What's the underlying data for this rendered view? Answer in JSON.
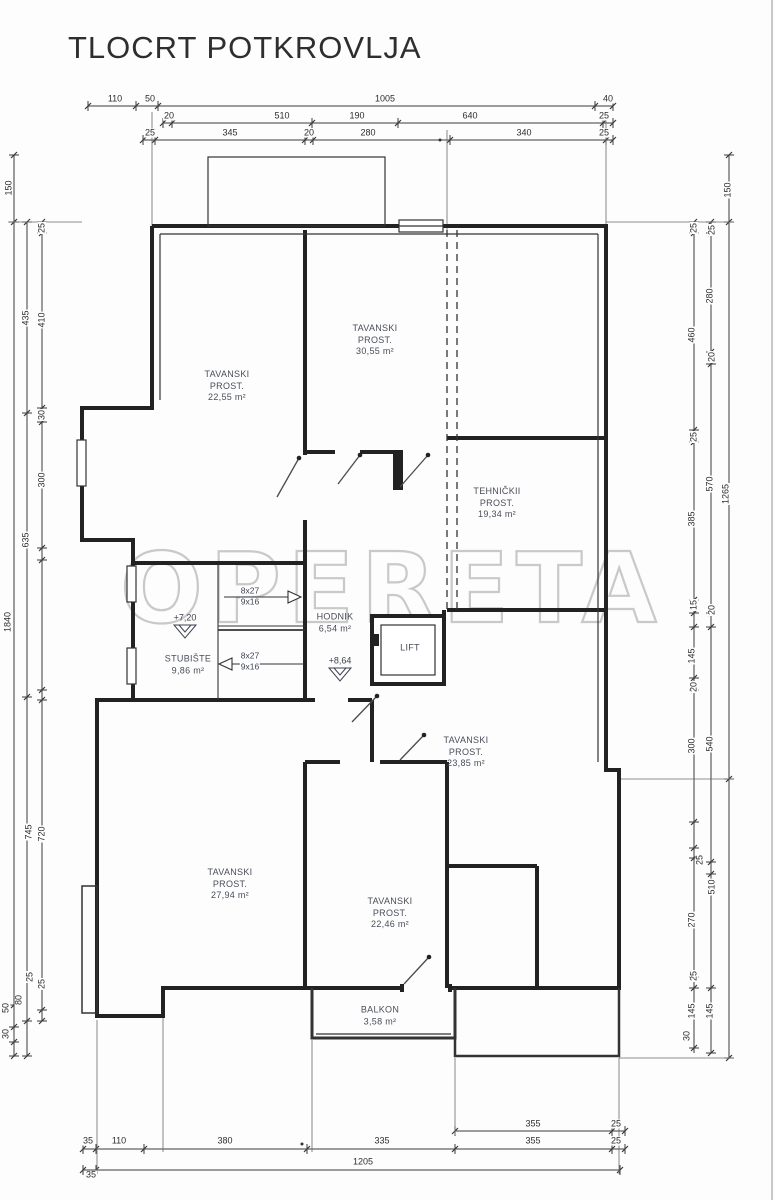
{
  "title": "TLOCRT POTKROVLJA",
  "watermark": "OPERETA",
  "rooms": [
    {
      "lines": [
        "TAVANSKI",
        "PROST.",
        "22,55 m²"
      ],
      "x": 227,
      "y": 386
    },
    {
      "lines": [
        "TAVANSKI",
        "PROST.",
        "30,55 m²"
      ],
      "x": 375,
      "y": 340
    },
    {
      "lines": [
        "TEHNIČKII",
        "PROST.",
        "19,34 m²"
      ],
      "x": 497,
      "y": 503
    },
    {
      "lines": [
        "STUBIŠTE",
        "9,86 m²"
      ],
      "x": 188,
      "y": 665
    },
    {
      "lines": [
        "HODNIK",
        "6,54 m²"
      ],
      "x": 335,
      "y": 623
    },
    {
      "lines": [
        "LIFT"
      ],
      "x": 410,
      "y": 648
    },
    {
      "lines": [
        "TAVANSKI",
        "PROST.",
        "23,85 m²"
      ],
      "x": 466,
      "y": 752
    },
    {
      "lines": [
        "TAVANSKI",
        "PROST.",
        "27,94 m²"
      ],
      "x": 230,
      "y": 884
    },
    {
      "lines": [
        "TAVANSKI",
        "PROST.",
        "22,46 m²"
      ],
      "x": 390,
      "y": 913
    },
    {
      "lines": [
        "BALKON",
        "3,58 m²"
      ],
      "x": 380,
      "y": 1016
    }
  ],
  "stair_labels": [
    {
      "text": "8x27",
      "x": 250,
      "y": 591
    },
    {
      "text": "9x16",
      "x": 250,
      "y": 602
    },
    {
      "text": "8x27",
      "x": 250,
      "y": 656
    },
    {
      "text": "9x16",
      "x": 250,
      "y": 667
    }
  ],
  "elevation_markers": [
    {
      "text": "+7,20",
      "x": 185,
      "y": 618
    },
    {
      "text": "+8,64",
      "x": 340,
      "y": 661
    }
  ],
  "dim_labels": [
    {
      "text": "110",
      "x": 115,
      "y": 99,
      "rot": false
    },
    {
      "text": "50",
      "x": 150,
      "y": 99,
      "rot": false
    },
    {
      "text": "1005",
      "x": 385,
      "y": 99,
      "rot": false
    },
    {
      "text": "40",
      "x": 608,
      "y": 99,
      "rot": false
    },
    {
      "text": "20",
      "x": 169,
      "y": 116,
      "rot": false
    },
    {
      "text": "510",
      "x": 282,
      "y": 116,
      "rot": false
    },
    {
      "text": "190",
      "x": 357,
      "y": 116,
      "rot": false
    },
    {
      "text": "640",
      "x": 470,
      "y": 116,
      "rot": false
    },
    {
      "text": "25",
      "x": 604,
      "y": 116,
      "rot": false
    },
    {
      "text": "25",
      "x": 150,
      "y": 133,
      "rot": false
    },
    {
      "text": "345",
      "x": 230,
      "y": 133,
      "rot": false
    },
    {
      "text": "20",
      "x": 309,
      "y": 133,
      "rot": false
    },
    {
      "text": "280",
      "x": 368,
      "y": 133,
      "rot": false
    },
    {
      "text": "340",
      "x": 524,
      "y": 133,
      "rot": false
    },
    {
      "text": "25",
      "x": 604,
      "y": 133,
      "rot": false
    },
    {
      "text": "150",
      "x": 9,
      "y": 188,
      "rot": true
    },
    {
      "text": "1840",
      "x": 8,
      "y": 622,
      "rot": true
    },
    {
      "text": "50",
      "x": 6,
      "y": 1008,
      "rot": true
    },
    {
      "text": "30",
      "x": 6,
      "y": 1034,
      "rot": true
    },
    {
      "text": "435",
      "x": 26,
      "y": 318,
      "rot": true
    },
    {
      "text": "635",
      "x": 26,
      "y": 540,
      "rot": true
    },
    {
      "text": "745",
      "x": 29,
      "y": 832,
      "rot": true
    },
    {
      "text": "80",
      "x": 19,
      "y": 1000,
      "rot": true
    },
    {
      "text": "25",
      "x": 42,
      "y": 228,
      "rot": true
    },
    {
      "text": "410",
      "x": 42,
      "y": 320,
      "rot": true
    },
    {
      "text": "30",
      "x": 42,
      "y": 415,
      "rot": true
    },
    {
      "text": "300",
      "x": 42,
      "y": 480,
      "rot": true
    },
    {
      "text": "720",
      "x": 42,
      "y": 834,
      "rot": true
    },
    {
      "text": "25",
      "x": 30,
      "y": 977,
      "rot": true
    },
    {
      "text": "25",
      "x": 42,
      "y": 984,
      "rot": true
    },
    {
      "text": "25",
      "x": 694,
      "y": 228,
      "rot": true
    },
    {
      "text": "460",
      "x": 692,
      "y": 335,
      "rot": true
    },
    {
      "text": "25",
      "x": 694,
      "y": 437,
      "rot": true
    },
    {
      "text": "385",
      "x": 692,
      "y": 519,
      "rot": true
    },
    {
      "text": "15",
      "x": 694,
      "y": 605,
      "rot": true
    },
    {
      "text": "145",
      "x": 692,
      "y": 656,
      "rot": true
    },
    {
      "text": "20",
      "x": 694,
      "y": 687,
      "rot": true
    },
    {
      "text": "300",
      "x": 692,
      "y": 746,
      "rot": true
    },
    {
      "text": "25",
      "x": 700,
      "y": 860,
      "rot": true
    },
    {
      "text": "270",
      "x": 692,
      "y": 920,
      "rot": true
    },
    {
      "text": "25",
      "x": 694,
      "y": 976,
      "rot": true
    },
    {
      "text": "145",
      "x": 692,
      "y": 1011,
      "rot": true
    },
    {
      "text": "30",
      "x": 687,
      "y": 1036,
      "rot": true
    },
    {
      "text": "25",
      "x": 712,
      "y": 230,
      "rot": true
    },
    {
      "text": "280",
      "x": 710,
      "y": 296,
      "rot": true
    },
    {
      "text": "20",
      "x": 712,
      "y": 357,
      "rot": true
    },
    {
      "text": "570",
      "x": 710,
      "y": 484,
      "rot": true
    },
    {
      "text": "20",
      "x": 712,
      "y": 610,
      "rot": true
    },
    {
      "text": "540",
      "x": 710,
      "y": 744,
      "rot": true
    },
    {
      "text": "510",
      "x": 712,
      "y": 887,
      "rot": true
    },
    {
      "text": "145",
      "x": 710,
      "y": 1011,
      "rot": true
    },
    {
      "text": "150",
      "x": 728,
      "y": 190,
      "rot": true
    },
    {
      "text": "1265",
      "x": 726,
      "y": 494,
      "rot": true
    },
    {
      "text": "355",
      "x": 533,
      "y": 1124,
      "rot": false
    },
    {
      "text": "25",
      "x": 616,
      "y": 1124,
      "rot": false
    },
    {
      "text": "35",
      "x": 88,
      "y": 1141,
      "rot": false
    },
    {
      "text": "110",
      "x": 119,
      "y": 1141,
      "rot": false
    },
    {
      "text": "380",
      "x": 225,
      "y": 1141,
      "rot": false
    },
    {
      "text": "335",
      "x": 382,
      "y": 1141,
      "rot": false
    },
    {
      "text": "355",
      "x": 533,
      "y": 1141,
      "rot": false
    },
    {
      "text": "25",
      "x": 616,
      "y": 1141,
      "rot": false
    },
    {
      "text": "35",
      "x": 91,
      "y": 1175,
      "rot": false
    },
    {
      "text": "1205",
      "x": 363,
      "y": 1162,
      "rot": false
    }
  ]
}
